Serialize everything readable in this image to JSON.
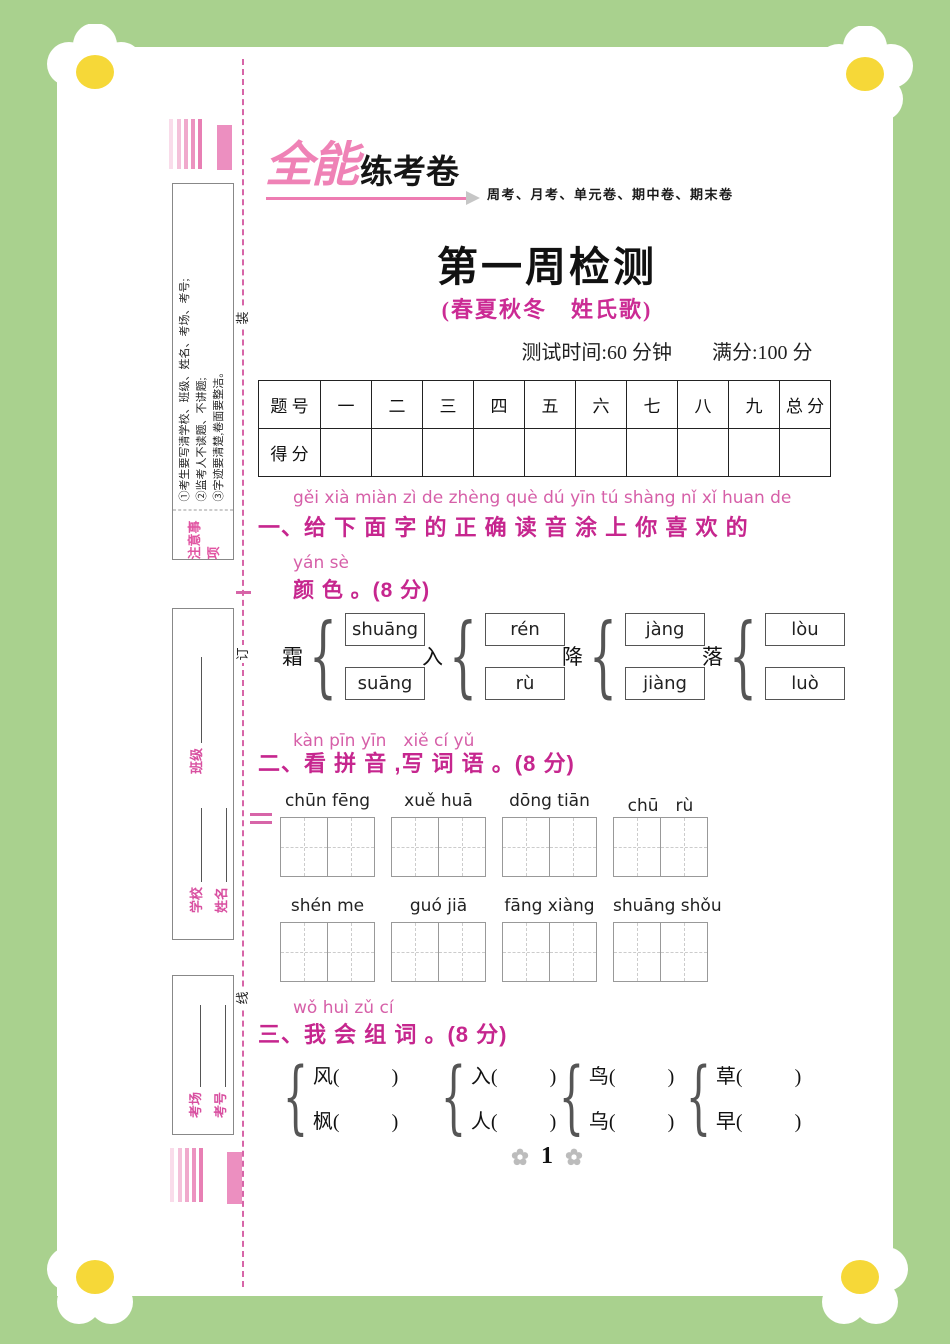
{
  "colors": {
    "border_green": "#a9d18e",
    "magenta_heading": "#c6268e",
    "pinyin_pink": "#d65fa8",
    "brand_pink": "#ef82b6",
    "binding_pink": "#d765a8",
    "daisy_center_yellow": "#f6d838"
  },
  "decor": {
    "binding_chars": [
      "装",
      "订",
      "线"
    ],
    "brace": "{"
  },
  "sidebar": {
    "notice": {
      "label": "注意事项",
      "lines": [
        "①考生要写清学校、班级、姓名、考场、考号;",
        "②监考人不读题、不讲题;",
        "③字迹要清楚,卷面要整洁。"
      ]
    },
    "info": {
      "school_label": "学校",
      "class_label": "班级",
      "name_label": "姓名"
    },
    "exam": {
      "room_label": "考场",
      "number_label": "考号"
    }
  },
  "header": {
    "brand_main": "全能",
    "brand_sub": "练考卷",
    "tagline": "周考、月考、单元卷、期中卷、期末卷",
    "title": "第一周检测",
    "subtitle": "(春夏秋冬　姓氏歌)",
    "meta": "测试时间:60 分钟　　满分:100 分"
  },
  "score_table": {
    "row1_label": "题 号",
    "row2_label": "得 分",
    "columns": [
      "一",
      "二",
      "三",
      "四",
      "五",
      "六",
      "七",
      "八",
      "九",
      "总 分"
    ]
  },
  "sections": {
    "one": {
      "pinyin": "gěi xià miàn zì de zhèng què dú yīn tú shàng nǐ xǐ huan de",
      "title": "一、给 下 面 字 的 正 确 读 音 涂 上 你 喜 欢 的",
      "pinyin2": "yán sè",
      "title2": "颜 色 。(8 分)",
      "choices": [
        {
          "char": "霜",
          "top": "shuāng",
          "bottom": "suāng"
        },
        {
          "char": "入",
          "top": "rén",
          "bottom": "rù"
        },
        {
          "char": "降",
          "top": "jàng",
          "bottom": "jiàng"
        },
        {
          "char": "落",
          "top": "lòu",
          "bottom": "luò"
        }
      ]
    },
    "two": {
      "pinyin": "kàn pīn yīn　xiě cí yǔ",
      "title": "二、看 拼 音 ,写 词 语 。(8 分)",
      "row1": [
        "chūn fēng",
        "xuě  huā",
        "dōng tiān",
        "chū　rù"
      ],
      "row2": [
        "shén  me",
        "guó  jiā",
        "fāng xiàng",
        "shuāng shǒu"
      ]
    },
    "three": {
      "pinyin": "wǒ huì zǔ cí",
      "title": "三、我 会 组 词 。(8 分)",
      "groups": [
        [
          "风",
          "枫"
        ],
        [
          "入",
          "人"
        ],
        [
          "鸟",
          "乌"
        ],
        [
          "草",
          "早"
        ]
      ],
      "paren_open": "(",
      "paren_close": ")"
    }
  },
  "footer": {
    "page_number": "1"
  }
}
